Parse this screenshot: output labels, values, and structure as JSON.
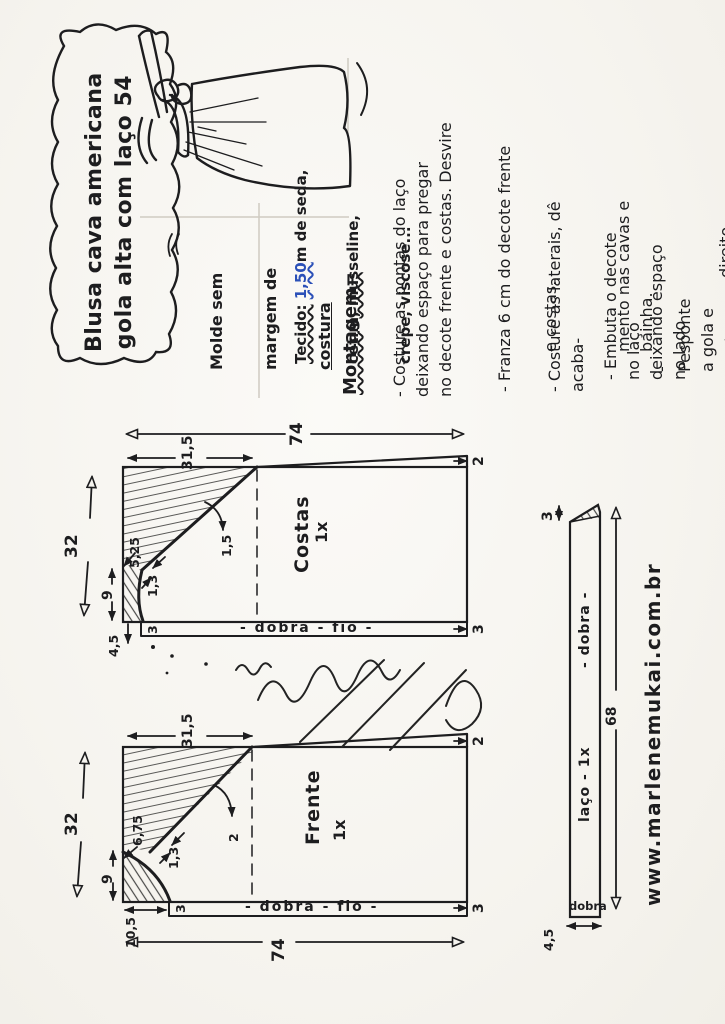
{
  "page": {
    "ink": "#1d1d1f",
    "paper": "#f6f4ef",
    "pencil": "#cfcbc2",
    "blue": "#2b50b8"
  },
  "title": {
    "text": "Blusa cava americana\ngola alta com laço 54"
  },
  "molde": {
    "l1": "Molde sem",
    "l2": "margem de",
    "l3": "costura"
  },
  "tecido": {
    "label": "Tecido:",
    "amount": "1,50",
    "rest": "m de seda,",
    "l2": "cetim, musseline,",
    "l3": "crepe, viscose..."
  },
  "montagem": {
    "header": "Montagem=",
    "b1": "- Costure as pontas do laço\ndeixando espaço para pregar\nno decote frente e costas. Desvire",
    "b2_l1": "- Franza 6 cm do decote frente",
    "b2_l2": "e costas.",
    "b3_l1": "- Costure as laterais, dê acaba-",
    "b3_l2": "mento nas cavas e bainha.",
    "b4_l1": "- Embuta o decote no laço\ndeixando espaço no lado",
    "b4_l3a": "direito de ",
    "b4_l3b": "12 cm",
    "b5": "- Pesponte a gola e pontas."
  },
  "costas": {
    "label": "Costas",
    "qty": "1x",
    "length": "74",
    "width": "32",
    "top_section": "31,5",
    "neck_depth": "9",
    "shoulder": "5,25",
    "ease_a": "1,3",
    "ease_b": "1,5",
    "rise": "2",
    "hem": "3",
    "hem_left": "3",
    "neck_offset": "4,5",
    "fold_line": "- dobra - fio -"
  },
  "frente": {
    "label": "Frente",
    "qty": "1x",
    "length": "74",
    "width": "32",
    "top_section": "31,5",
    "neck_depth": "9",
    "shoulder": "6,75",
    "ease_a": "1,3",
    "ease_b": "2",
    "rise": "2",
    "hem": "3",
    "hem_left": "3",
    "neck_width": "10,5",
    "fold_line": "- dobra - fio -"
  },
  "laco": {
    "length": "68",
    "tip": "3",
    "label": "laço - 1x",
    "fold_mid": "- dobra -",
    "fold_end": "dobra",
    "width": "4,5"
  },
  "site": {
    "url": "www.marlenemukai.com.br"
  }
}
